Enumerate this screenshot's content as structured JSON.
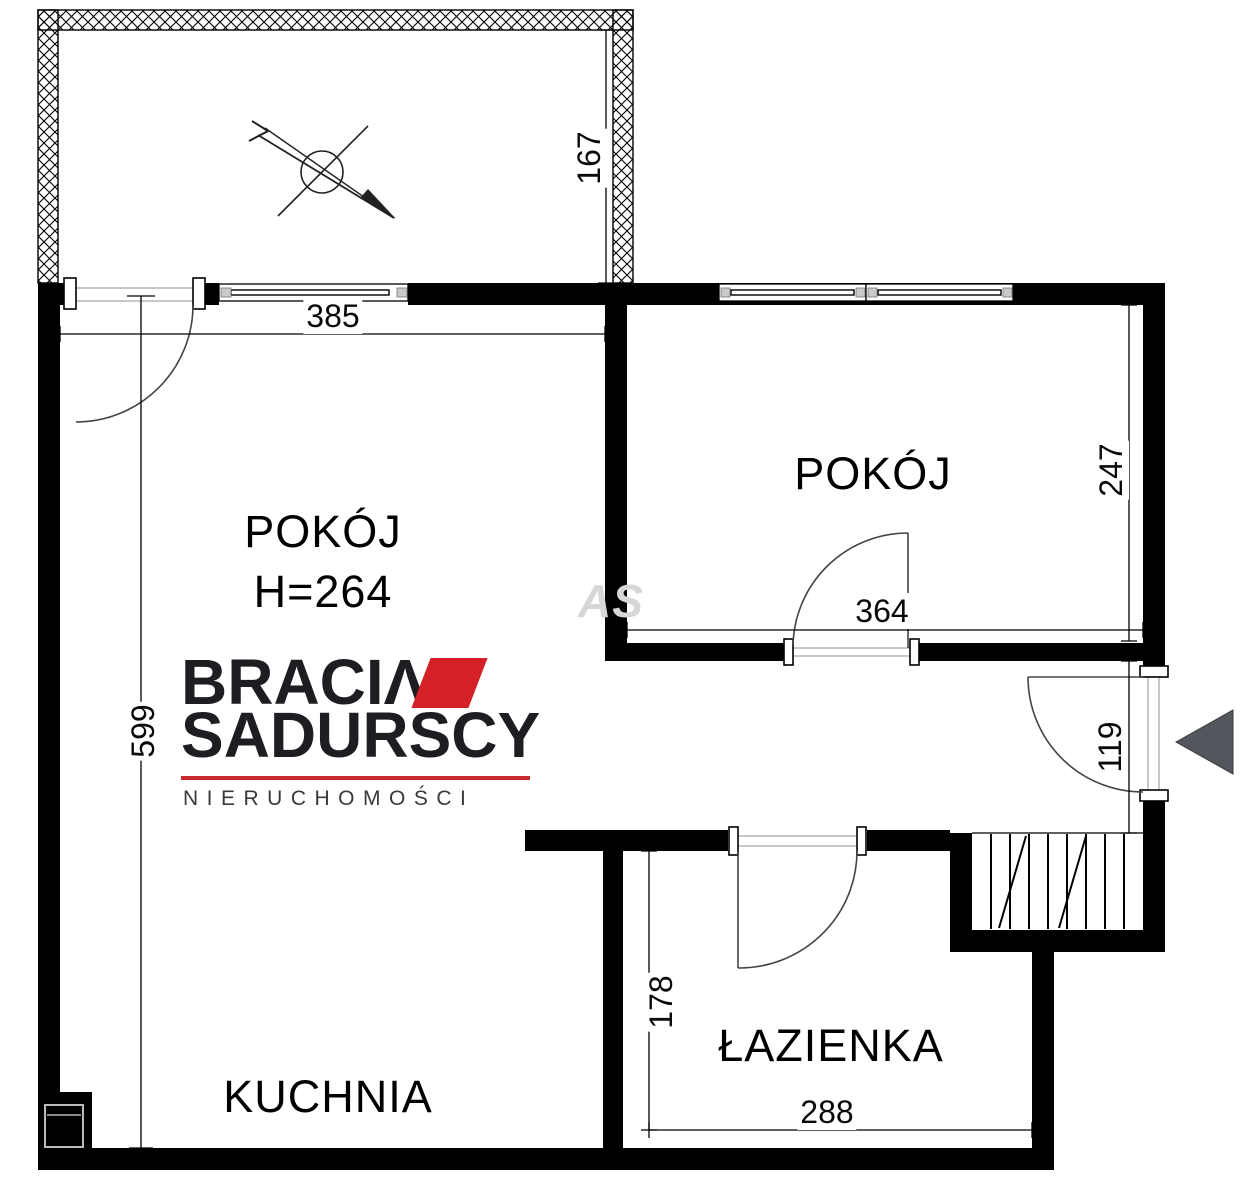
{
  "plan": {
    "watermark": "AS",
    "rooms": {
      "main": {
        "label": "POKÓJ",
        "height_label": "H=264"
      },
      "right": {
        "label": "POKÓJ"
      },
      "kitchen": {
        "label": "KUCHNIA"
      },
      "bath": {
        "label": "ŁAZIENKA"
      }
    },
    "dims": {
      "balcony_depth": "167",
      "main_window_width": "385",
      "main_room_length": "599",
      "right_room_depth": "247",
      "right_room_width": "364",
      "entry_width": "119",
      "bath_depth": "178",
      "bath_width": "288"
    }
  },
  "logo": {
    "brand_word1": "BRACI",
    "brand_word1_accent": "Λ",
    "brand_word2": "SADURSCY",
    "tagline": "NIERUCHOMOŚCI",
    "accent_color": "#d42127",
    "rule_color": "#c62a2f",
    "text_color": "#1e1d21"
  },
  "symbols": {
    "entrance_arrow_color": "#54565e",
    "wall_color": "#000000"
  }
}
